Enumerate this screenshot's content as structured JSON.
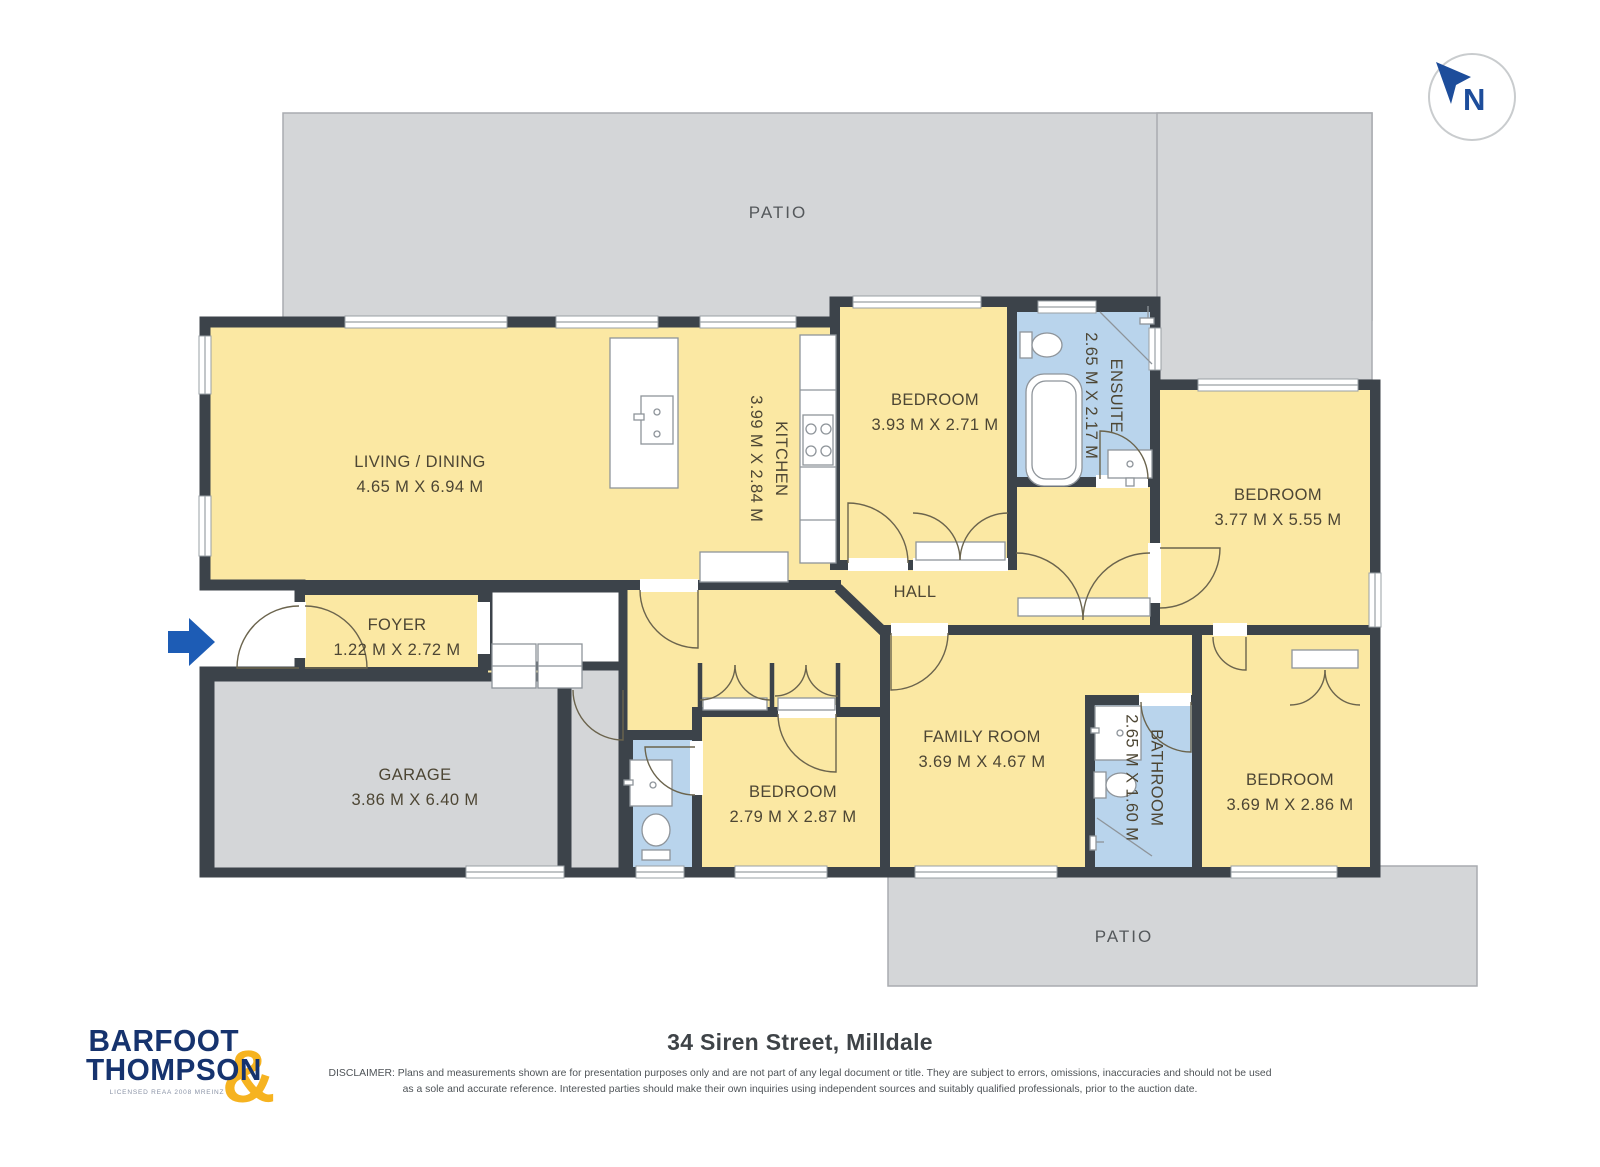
{
  "compass": {
    "label": "N"
  },
  "plan": {
    "patio_top": "PATIO",
    "patio_bottom": "PATIO",
    "hall": "HALL",
    "living": {
      "name": "LIVING / DINING",
      "dims": "4.65 M X 6.94 M"
    },
    "kitchen": {
      "name": "KITCHEN",
      "dims": "3.99 M X 2.84 M"
    },
    "bedroom_top": {
      "name": "BEDROOM",
      "dims": "3.93 M X 2.71 M"
    },
    "ensuite": {
      "name": "ENSUITE",
      "dims": "2.65 M X 2.17 M"
    },
    "bedroom_right": {
      "name": "BEDROOM",
      "dims": "3.77 M X 5.55 M"
    },
    "foyer": {
      "name": "FOYER",
      "dims": "1.22 M X 2.72 M"
    },
    "garage": {
      "name": "GARAGE",
      "dims": "3.86 M X 6.40 M"
    },
    "bedroom_mid": {
      "name": "BEDROOM",
      "dims": "2.79 M X 2.87 M"
    },
    "family_room": {
      "name": "FAMILY ROOM",
      "dims": "3.69 M X 4.67 M"
    },
    "bathroom": {
      "name": "BATHROOM",
      "dims": "2.65 M X 1.60 M"
    },
    "bedroom_bottom_right": {
      "name": "BEDROOM",
      "dims": "3.69 M X 2.86 M"
    }
  },
  "footer": {
    "logo_line1": "BARFOOT",
    "logo_line2": "THOMPSON",
    "logo_ampersand": "&",
    "logo_caption": "LICENSED REAA 2008 MREINZ",
    "address": "34 Siren Street, Milldale",
    "disclaimer_line1": "DISCLAIMER: Plans and measurements shown are for presentation purposes only and are not part of any legal document or title. They are subject to errors, omissions, inaccuracies and should not be used",
    "disclaimer_line2": "as a sole and accurate reference. Interested parties should make their own inquiries using independent sources and suitably qualified professionals, prior to the auction date."
  },
  "colors": {
    "wall": "#3c434a",
    "room_fill": "#fbe8a3",
    "wet_fill": "#b9d4ec",
    "outdoor_fill": "#d4d6d8",
    "brand_navy": "#16336e",
    "brand_yellow": "#f6b320",
    "compass_blue": "#1d4d9b",
    "entry_arrow_blue": "#1d5cb5",
    "label_text": "#4d4634",
    "outdoor_text": "#54585b",
    "footer_text": "#3e4347",
    "door_arc": "#6b644d"
  }
}
